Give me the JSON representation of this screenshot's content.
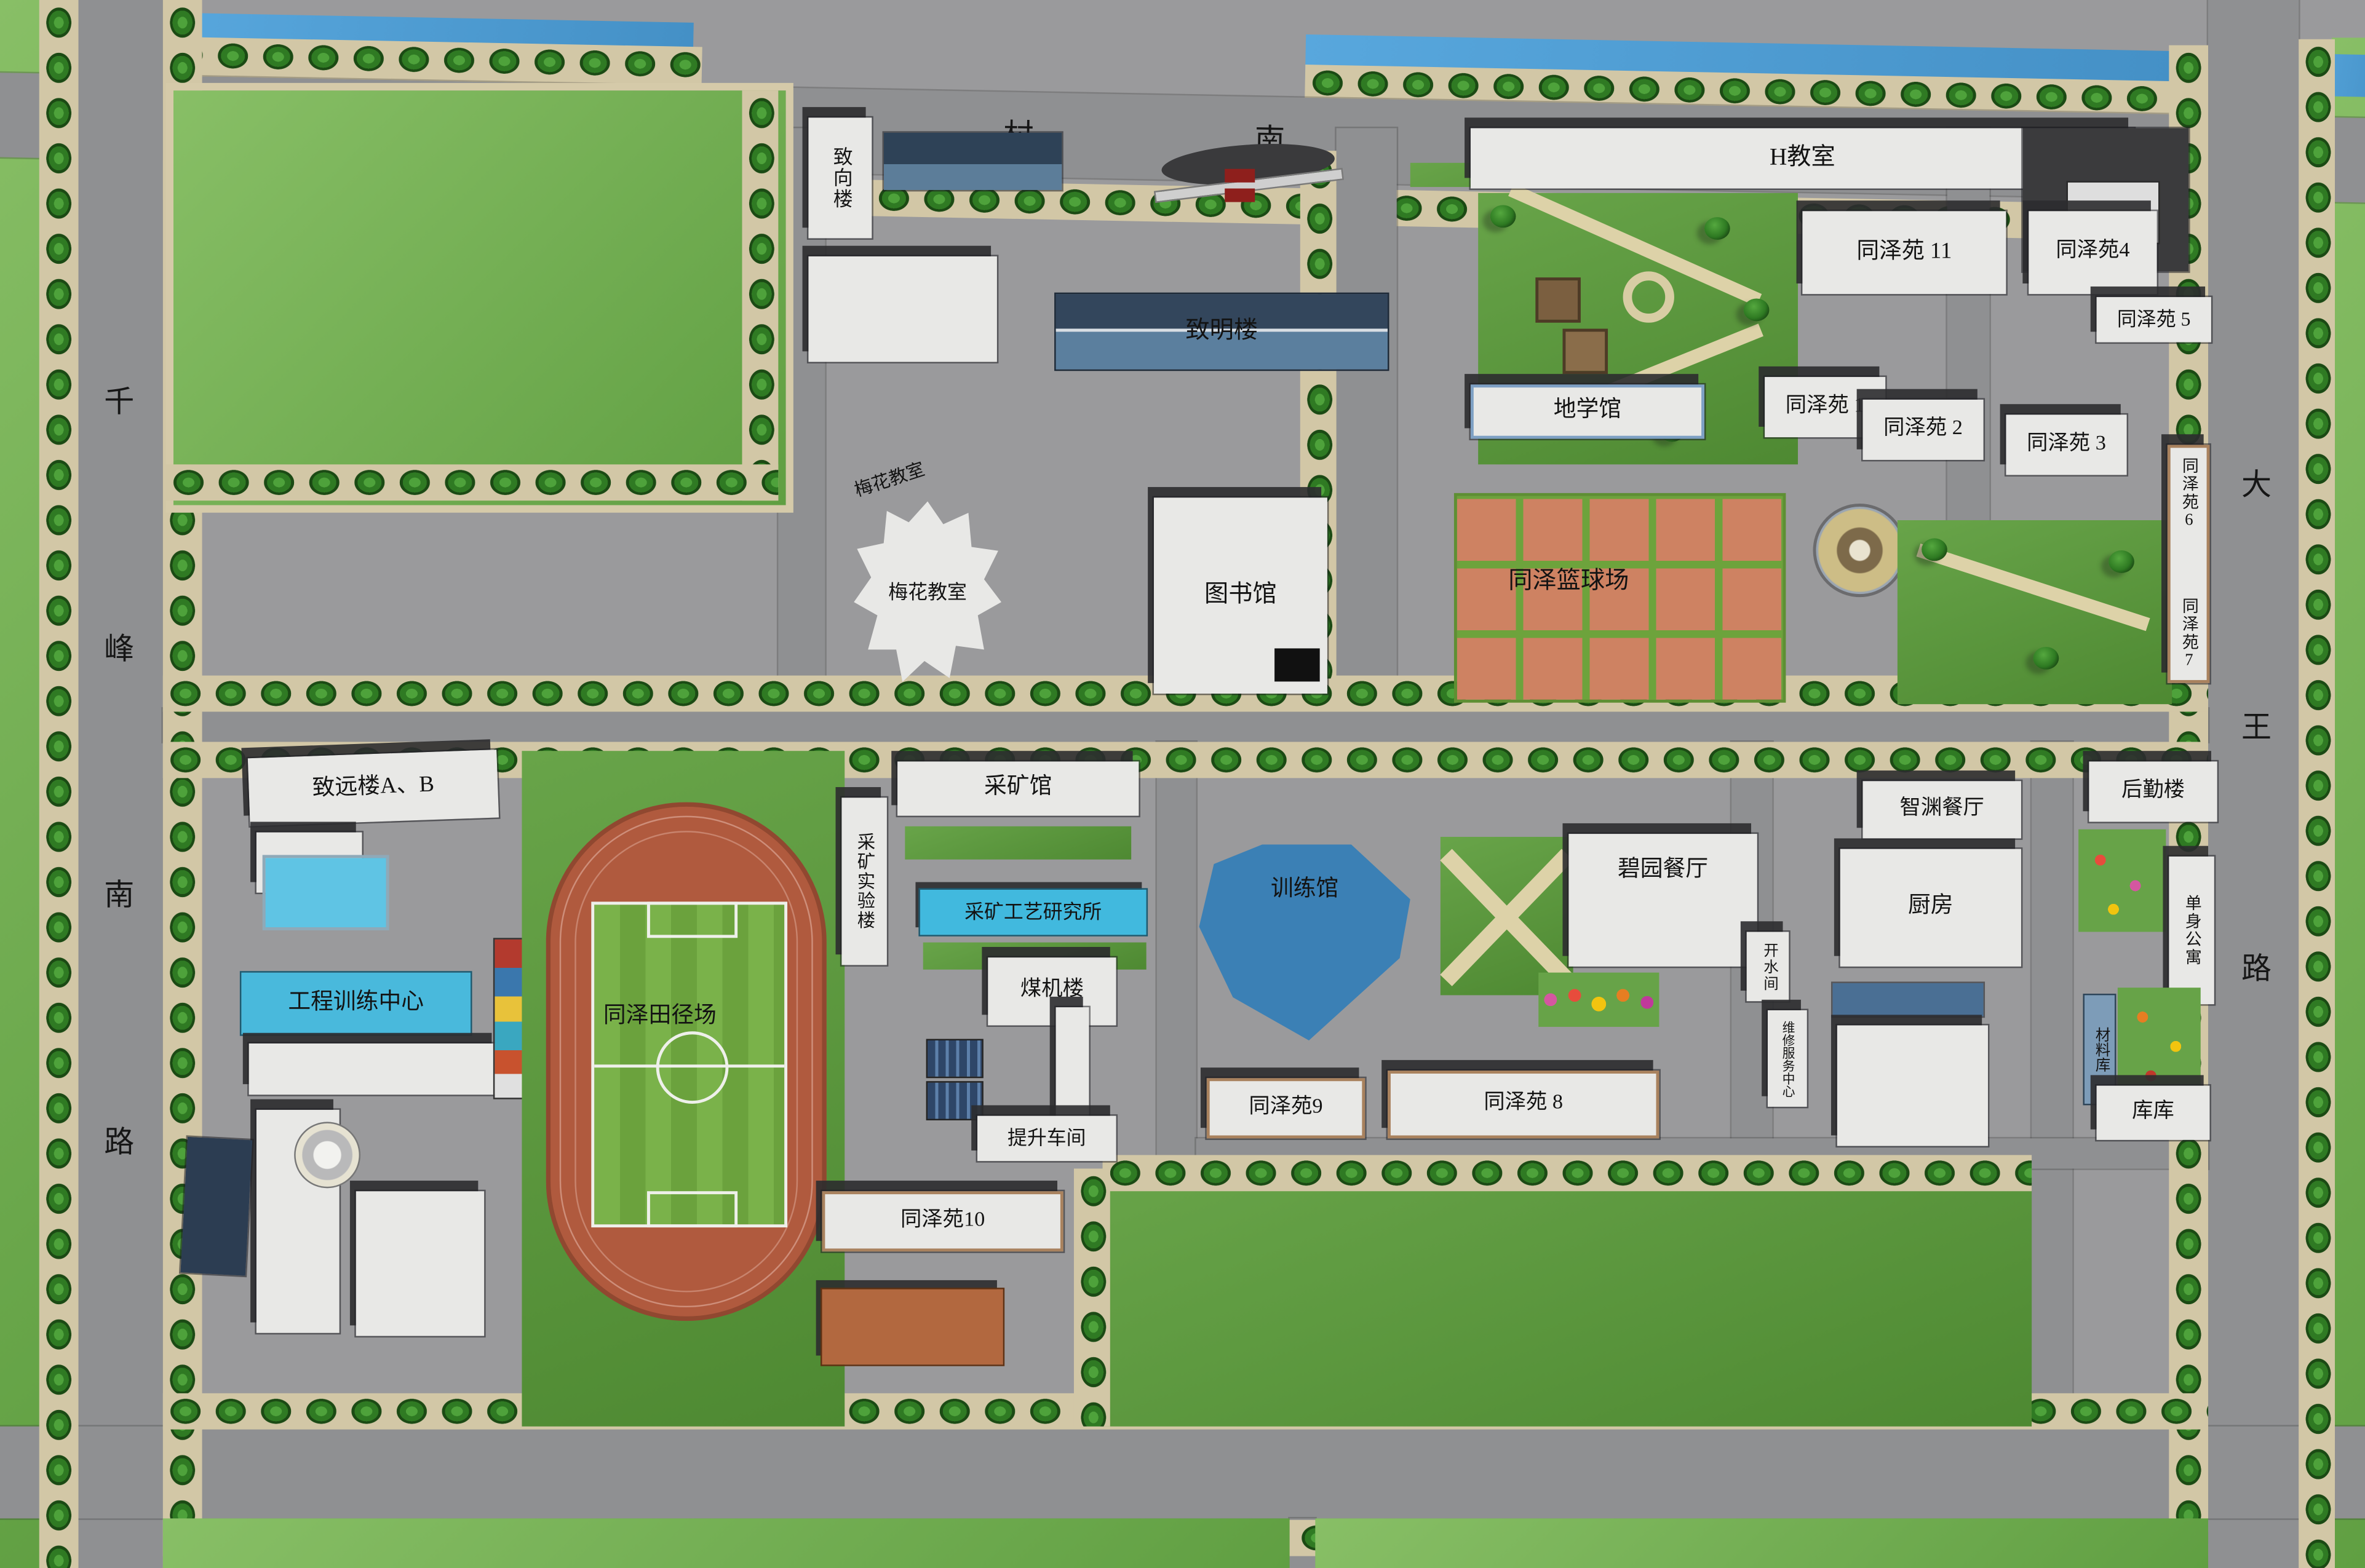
{
  "roads": {
    "north": "移村南街",
    "west": "千峰南路",
    "east": "大王路"
  },
  "buildings": {
    "zhixianglou": "致向楼",
    "zhiminglou": "致明楼",
    "h_classroom": "H教室",
    "tzy11": "同泽苑 11",
    "tzy4": "同泽苑4",
    "tzy5": "同泽苑 5",
    "dixueguan": "地学馆",
    "tzy1": "同泽苑 1",
    "tzy2": "同泽苑 2",
    "tzy3": "同泽苑 3",
    "tzy6": "同泽苑6",
    "tzy7": "同泽苑7",
    "meihua_hint": "梅花教室",
    "meihua": "梅花教室",
    "tushuguan": "图书馆",
    "basketball": "同泽篮球场",
    "zhiyuanlou": "致远楼A、B",
    "gongcheng": "工程训练中心",
    "track": "同泽田径场",
    "caikuangguan": "采矿馆",
    "caikuang_lab": "采矿实验楼",
    "caikuang_inst": "采矿工艺研究所",
    "xunlianguan": "训练馆",
    "meijilou": "煤机楼",
    "tisheng": "提升车间",
    "tzy9": "同泽苑9",
    "tzy8": "同泽苑 8",
    "tzy10": "同泽苑10",
    "biyuan": "碧园餐厅",
    "kaishui": "开水间",
    "weixiu": "维修服务中心",
    "zhiyuan_canting": "智渊餐厅",
    "chufang": "厨房",
    "houqin": "后勤楼",
    "danshen": "单身公寓",
    "cailiao": "材料库",
    "kuku": "库库"
  },
  "colors": {
    "road": "#8f9092",
    "campus": "#9a9a9c",
    "lawn": "#6fae55",
    "lawn_dark": "#578f38",
    "water": "#4d9bd4",
    "building": "#e8e8e6",
    "blue_building": "#45b8dc",
    "training_hall": "#3b80b5",
    "track_ring": "#b05a3e",
    "court": "#ce8262",
    "sidewalk": "#d2c7a6"
  }
}
